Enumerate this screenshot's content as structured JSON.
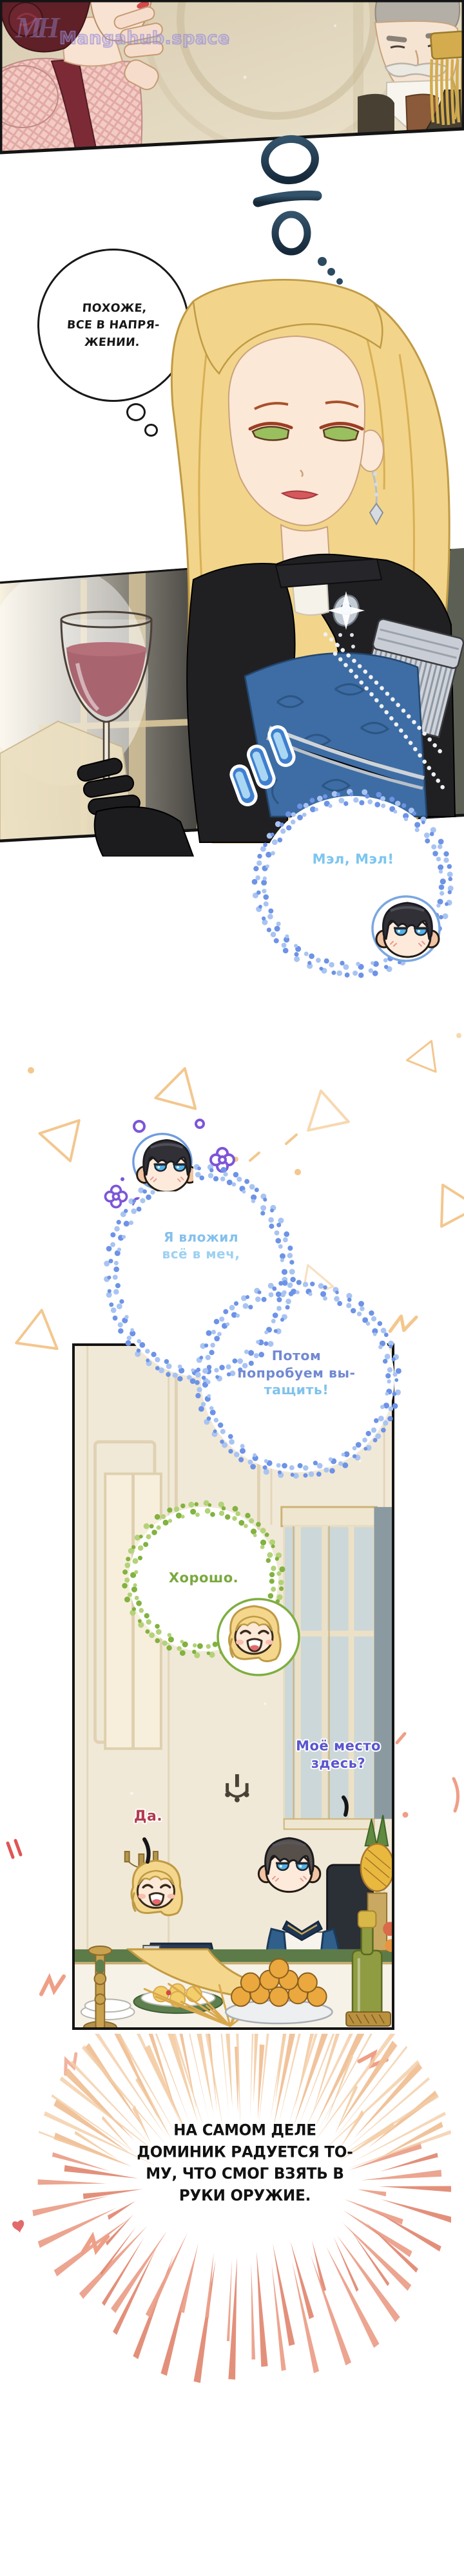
{
  "watermark": {
    "logo": "MH",
    "site": "Mangahub.space"
  },
  "panel_top": {
    "sfx_hmm": "음..."
  },
  "thought_bubble": {
    "lines": [
      "ПОХОЖЕ,",
      "ВСЕ В НАПРЯ-",
      "ЖЕНИИ."
    ]
  },
  "bubble_mel": {
    "text": "Мэл, Мэл!"
  },
  "bubble_sword": {
    "lines": [
      "Я вложил",
      "всё в меч,"
    ]
  },
  "bubble_pull": {
    "lines": [
      "Потом",
      "попробуем вы-",
      "тащить!"
    ]
  },
  "bubble_ok": {
    "text": "Хорошо."
  },
  "dinner_panel": {
    "speech_place": {
      "lines": [
        "Моё место",
        "здесь?"
      ]
    },
    "speech_yes": {
      "text": "Да."
    }
  },
  "caption": {
    "lines": [
      "НА САМОМ ДЕЛЕ",
      "ДОМИНИК РАДУЕТСЯ ТО-",
      "МУ, ЧТО СМОГ ВЗЯТЬ В",
      "РУКИ ОРУЖИЕ."
    ]
  },
  "colors": {
    "mel_text": "#7cc6ee",
    "sword_text": "#84c0ec",
    "pull_text": "#7189d2",
    "pull_text_light": "#7fc2ec",
    "ok_text": "#79a93e",
    "place_text": "#5a55cf",
    "yes_text": "#b23a50",
    "caption_text": "#111111",
    "thought_text": "#161616",
    "dot_blue": "#6d93e6",
    "dot_blue_light": "#a9c4f2",
    "dot_green": "#82b23f",
    "dot_green_light": "#b3d279",
    "burst_salmon": "#eba08a",
    "burst_salmon2": "#e28a74",
    "burst_tan": "#f3cda6",
    "confetti_tan": "#f3c78e",
    "flower_purple": "#7d55d8",
    "watermark_purple": "#9a90d8"
  }
}
